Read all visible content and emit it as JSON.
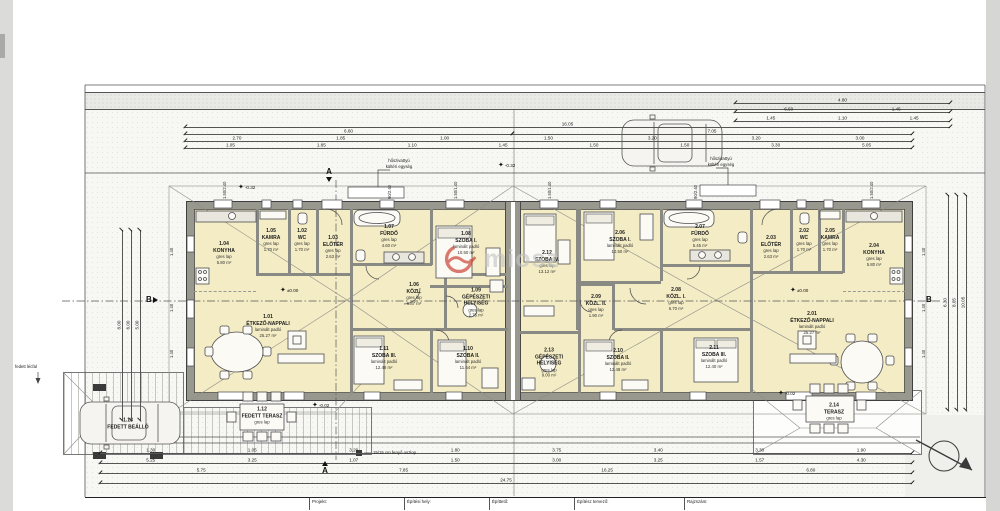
{
  "colors": {
    "room_fill": "#f3ecc4",
    "wall_gray": "#98988f",
    "accent_red": "#c62d1f",
    "paper": "#ffffff"
  },
  "watermark": {
    "text": "miosz"
  },
  "rooms": [
    {
      "number": "1.01",
      "name": "ÉTKEZŐ-NAPPALI",
      "floor": "laminált padló",
      "area": "25.27 m²"
    },
    {
      "number": "1.02",
      "name": "WC",
      "floor": "gres lap",
      "area": "1.70 m²"
    },
    {
      "number": "1.03",
      "name": "ELŐTÉR",
      "floor": "gres lap",
      "area": "2.63 m²"
    },
    {
      "number": "1.04",
      "name": "KONYHA",
      "floor": "gres lap",
      "area": "5.80 m²"
    },
    {
      "number": "1.05",
      "name": "KAMRA",
      "floor": "gres lap",
      "area": "1.70 m²"
    },
    {
      "number": "1.06",
      "name": "KÖZL.",
      "floor": "gres lap",
      "area": "6.87 m²"
    },
    {
      "number": "1.07",
      "name": "FÜRDŐ",
      "floor": "gres lap",
      "area": "4.60 m²"
    },
    {
      "number": "1.08",
      "name": "SZOBA I.",
      "floor": "laminált padló",
      "area": "10.50 m²"
    },
    {
      "number": "1.09",
      "name": "GÉPÉSZETI HELYISÉG",
      "floor": "gres lap",
      "area": "2.75 m²"
    },
    {
      "number": "1.10",
      "name": "SZOBA II.",
      "floor": "laminált padló",
      "area": "11.64 m²"
    },
    {
      "number": "1.11",
      "name": "SZOBA III.",
      "floor": "laminált padló",
      "area": "12.48 m²"
    },
    {
      "number": "1.12",
      "name": "FEDETT TERASZ",
      "floor": "gres lap",
      "area": ""
    },
    {
      "number": "1.13",
      "name": "FEDETT BEÁLLÓ",
      "floor": "",
      "area": ""
    },
    {
      "number": "2.01",
      "name": "ÉTKEZŐ-NAPPALI",
      "floor": "laminált padló",
      "area": "25.27 m²"
    },
    {
      "number": "2.02",
      "name": "WC",
      "floor": "gres lap",
      "area": "1.70 m²"
    },
    {
      "number": "2.03",
      "name": "ELŐTÉR",
      "floor": "gres lap",
      "area": "2.63 m²"
    },
    {
      "number": "2.04",
      "name": "KONYHA",
      "floor": "gres lap",
      "area": "5.80 m²"
    },
    {
      "number": "2.05",
      "name": "KAMRA",
      "floor": "gres lap",
      "area": "1.70 m²"
    },
    {
      "number": "2.06",
      "name": "SZOBA I.",
      "floor": "laminált padló",
      "area": "10.50 m²"
    },
    {
      "number": "2.07",
      "name": "FÜRDŐ",
      "floor": "gres lap",
      "area": "5.45 m²"
    },
    {
      "number": "2.08",
      "name": "KÖZL. I.",
      "floor": "gres lap",
      "area": "6.70 m²"
    },
    {
      "number": "2.09",
      "name": "KÖZL. II.",
      "floor": "gres lap",
      "area": "1.90 m²"
    },
    {
      "number": "2.10",
      "name": "SZOBA II.",
      "floor": "laminált padló",
      "area": "12.48 m²"
    },
    {
      "number": "2.11",
      "name": "SZOBA III.",
      "floor": "laminált padló",
      "area": "12.40 m²"
    },
    {
      "number": "2.12",
      "name": "SZOBA IV.",
      "floor": "gres lap",
      "area": "13.12 m²"
    },
    {
      "number": "2.13",
      "name": "GÉPÉSZETI HELYISÉG",
      "floor": "gres lap",
      "area": "9.00 m²"
    },
    {
      "number": "2.14",
      "name": "TERASZ",
      "floor": "gres lap",
      "area": ""
    }
  ],
  "levels": [
    "±0.00",
    "±0.00",
    "-0.32",
    "-0.32",
    "-0.02",
    "-0.02"
  ],
  "sections": {
    "a": "A",
    "b": "B"
  },
  "annotations": {
    "heat_pump_line1": "hőszivattyú",
    "heat_pump_line2": "kültéri egység",
    "post": "15/15 cm fenyő oszlop",
    "fence": "fedett lécfal"
  },
  "dims": {
    "top1": [
      "16.05"
    ],
    "top2a": [
      "6.60"
    ],
    "top2b": [
      "7.05"
    ],
    "top3": [
      "2.70",
      "1.85",
      "1.00",
      "1.50",
      "3.20",
      "3.20",
      "3.00"
    ],
    "top4": [
      "1.05",
      "1.85",
      "1.10",
      "1.45",
      "1.50",
      "1.50",
      "3.30",
      "5.05"
    ],
    "rt1": [
      "4.80"
    ],
    "rt2": [
      "6.50",
      "1.45"
    ],
    "rt3": [
      "1.45",
      "1.10",
      "1.45"
    ],
    "b1": [
      "1.30",
      "1.05",
      "3.20",
      "1.80",
      "3.75",
      "3.40",
      "3.30",
      "1.90"
    ],
    "b2": [
      "5.25",
      "3.25",
      "1.07",
      "1.50",
      "3.00",
      "3.25",
      "1.57",
      "4.30"
    ],
    "b3": [
      "5.75",
      "7.85",
      "16.25",
      "6.80"
    ],
    "b4": [
      "24.75"
    ],
    "lv1": [
      "8.00"
    ],
    "lv2": [
      "6.00"
    ],
    "lv3": [
      "5.00"
    ],
    "rv1": [
      "6.30"
    ],
    "rv2": [
      "8.05"
    ],
    "rv3": [
      "10.05"
    ],
    "wall": [
      "1.40",
      "1.40",
      "1.40",
      "1.40",
      "1.40",
      "1.40"
    ],
    "win": [
      "1.50/2.40",
      "90/2.40",
      "1.50/1.40",
      "1.50/1.40",
      "90/2.40",
      "1.50/2.40"
    ]
  },
  "title_block": {
    "f1": "Projekt:",
    "f2": "Építési hely:",
    "f3": "Építtető:",
    "f4": "Építész tervező:",
    "f5": "Rajzszám:"
  }
}
